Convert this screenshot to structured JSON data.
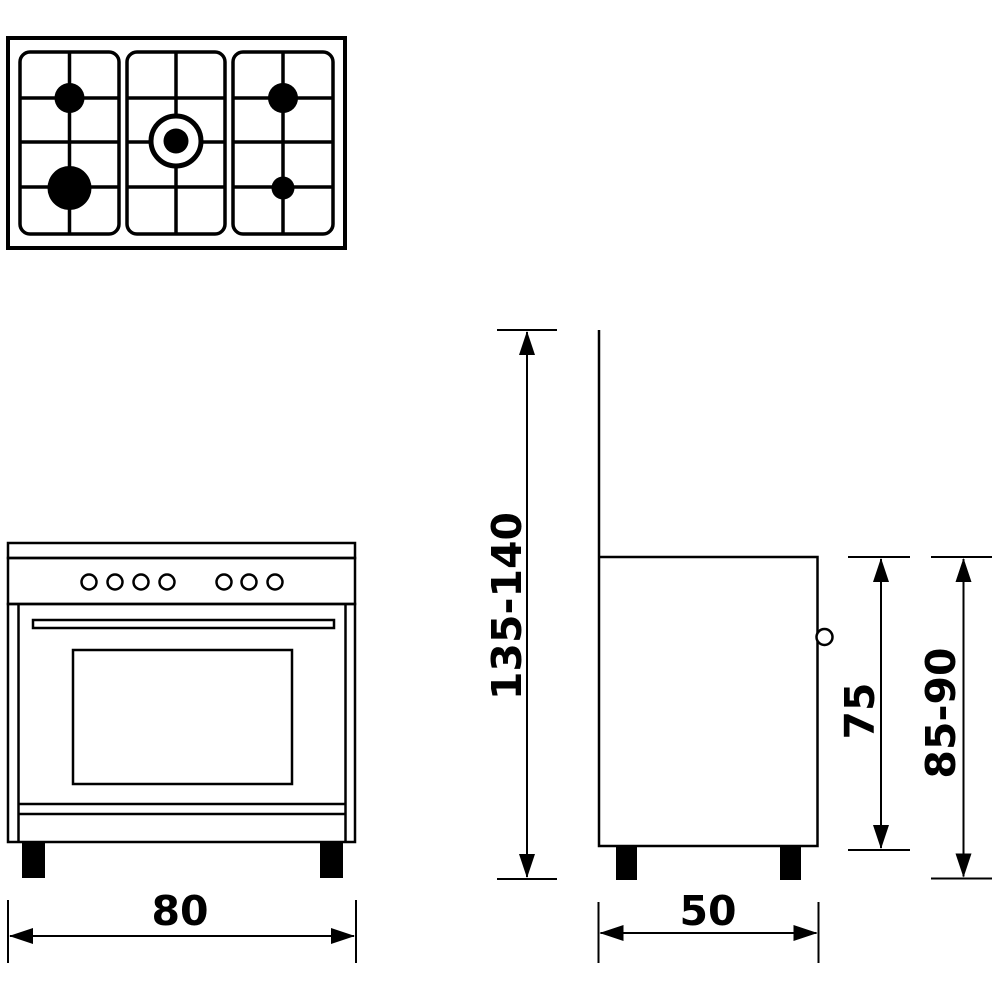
{
  "diagram": {
    "colors": {
      "line": "#000000",
      "background": "#ffffff"
    },
    "dimensions": {
      "width": "80",
      "depth": "50",
      "body_height": "75",
      "worktop_height": "85-90",
      "total_height": "135-140"
    }
  }
}
